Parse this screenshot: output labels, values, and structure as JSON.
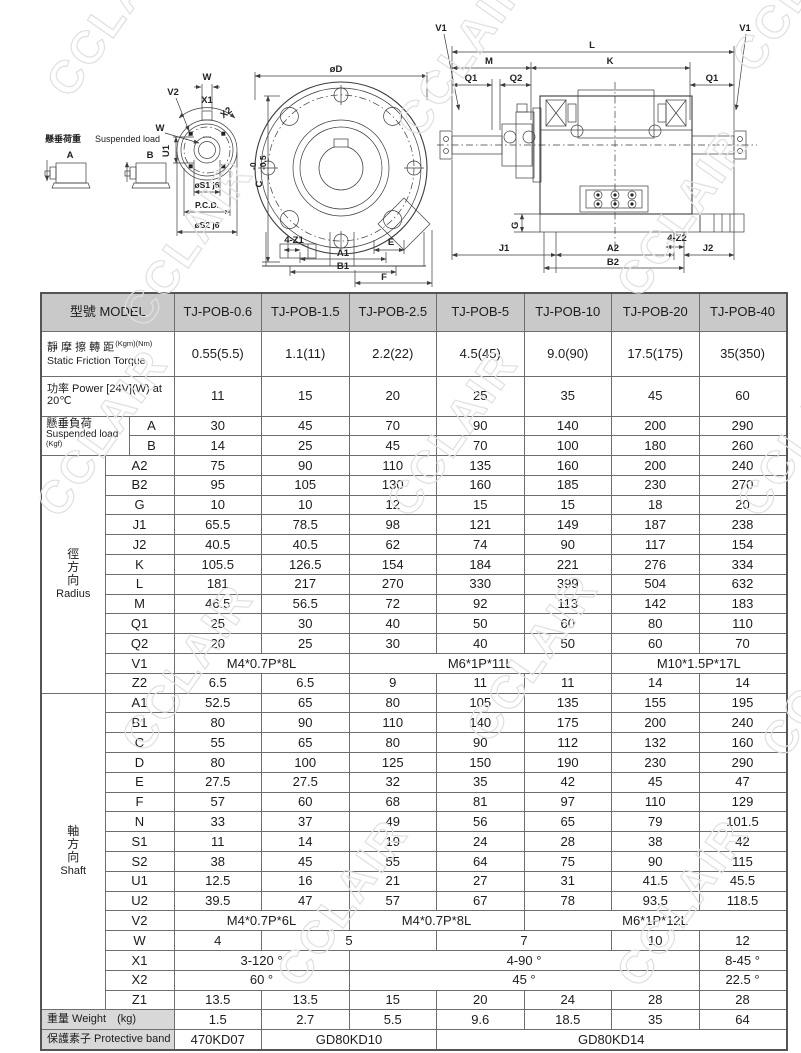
{
  "page": {
    "watermark": "CCLAIR"
  },
  "colors": {
    "header_bg": "#c9c9c9",
    "label_bg": "#d8d8d8",
    "border": "#6e6e6e",
    "line": "#3c3c3c",
    "watermark": "#e0e0e0",
    "text": "#1c1c1c"
  },
  "drawings": {
    "suspended_legend": {
      "zh": "懸垂荷重",
      "en": "Suspended load",
      "a": "A",
      "b": "B"
    },
    "front_small": {
      "v2": "V2",
      "w_top": "W",
      "x1": "X1",
      "x2": "X2",
      "w_left": "W",
      "u1": "U1",
      "s1": "øS1 j6",
      "pcd": "P.C.D.",
      "s2": "øS2 j6"
    },
    "front_large": {
      "d": "øD",
      "c": "C",
      "c_tol_top": "-0",
      "c_tol_bot": "-0.5",
      "z1": "4-Z1",
      "a1": "A1",
      "b1": "B1",
      "e": "E",
      "f": "F"
    },
    "side": {
      "v1l": "V1",
      "v1r": "V1",
      "l": "L",
      "m": "M",
      "k": "K",
      "q1l": "Q1",
      "q2": "Q2",
      "q1r": "Q1",
      "g": "G",
      "j1": "J1",
      "a2": "A2",
      "z2": "4-Z2",
      "j2": "J2",
      "b2": "B2"
    }
  },
  "table": {
    "header": {
      "label": "型號 MODEL",
      "models": [
        "TJ-POB-0.6",
        "TJ-POB-1.5",
        "TJ-POB-2.5",
        "TJ-POB-5",
        "TJ-POB-10",
        "TJ-POB-20",
        "TJ-POB-40"
      ]
    },
    "sections": [
      {
        "l1": "靜 摩 擦 轉 距",
        "unit": "(Kgm)(Nm)",
        "l2": "Static Friction Torque",
        "tall": "torque",
        "cells": [
          "0.55(5.5)",
          "1.1(11)",
          "2.2(22)",
          "4.5(45)",
          "9.0(90)",
          "17.5(175)",
          "35(350)"
        ]
      },
      {
        "l1": "功率 Power [24V](W) at 20℃",
        "tall": "power",
        "cells": [
          "11",
          "15",
          "20",
          "25",
          "35",
          "45",
          "60"
        ]
      },
      {
        "group_l1": "懸垂負荷",
        "group_l2": "Suspended load",
        "group_unit": "(Kgf)",
        "glabel_span": 2,
        "sub_span": 1,
        "rows": [
          {
            "name": "A",
            "cells": [
              "30",
              "45",
              "70",
              "90",
              "140",
              "200",
              "290"
            ]
          },
          {
            "name": "B",
            "cells": [
              "14",
              "25",
              "45",
              "70",
              "100",
              "180",
              "260"
            ]
          }
        ]
      },
      {
        "group_vertical": [
          "徑",
          "方",
          "向"
        ],
        "group_en": "Radius",
        "glabel_span": 1,
        "sub_span": 2,
        "rows": [
          {
            "name": "A2",
            "cells": [
              "75",
              "90",
              "110",
              "135",
              "160",
              "200",
              "240"
            ]
          },
          {
            "name": "B2",
            "cells": [
              "95",
              "105",
              "130",
              "160",
              "185",
              "230",
              "270"
            ]
          },
          {
            "name": "G",
            "cells": [
              "10",
              "10",
              "12",
              "15",
              "15",
              "18",
              "20"
            ]
          },
          {
            "name": "J1",
            "cells": [
              "65.5",
              "78.5",
              "98",
              "121",
              "149",
              "187",
              "238"
            ]
          },
          {
            "name": "J2",
            "cells": [
              "40.5",
              "40.5",
              "62",
              "74",
              "90",
              "117",
              "154"
            ]
          },
          {
            "name": "K",
            "cells": [
              "105.5",
              "126.5",
              "154",
              "184",
              "221",
              "276",
              "334"
            ]
          },
          {
            "name": "L",
            "cells": [
              "181",
              "217",
              "270",
              "330",
              "399",
              "504",
              "632"
            ]
          },
          {
            "name": "M",
            "cells": [
              "46.5",
              "56.5",
              "72",
              "92",
              "113",
              "142",
              "183"
            ]
          },
          {
            "name": "Q1",
            "cells": [
              "25",
              "30",
              "40",
              "50",
              "60",
              "80",
              "110"
            ]
          },
          {
            "name": "Q2",
            "cells": [
              "20",
              "25",
              "30",
              "40",
              "50",
              "60",
              "70"
            ]
          },
          {
            "name": "V1",
            "cells": [
              [
                "M4*0.7P*8L",
                2
              ],
              [
                "M6*1P*11L",
                3
              ],
              [
                "M10*1.5P*17L",
                2
              ]
            ]
          },
          {
            "name": "Z2",
            "cells": [
              "6.5",
              "6.5",
              "9",
              "11",
              "11",
              "14",
              "14"
            ]
          }
        ]
      },
      {
        "group_vertical": [
          "軸",
          "方",
          "向"
        ],
        "group_en": "Shaft",
        "glabel_span": 1,
        "sub_span": 2,
        "rows": [
          {
            "name": "A1",
            "cells": [
              "52.5",
              "65",
              "80",
              "105",
              "135",
              "155",
              "195"
            ]
          },
          {
            "name": "B1",
            "cells": [
              "80",
              "90",
              "110",
              "140",
              "175",
              "200",
              "240"
            ]
          },
          {
            "name": "C",
            "cells": [
              "55",
              "65",
              "80",
              "90",
              "112",
              "132",
              "160"
            ]
          },
          {
            "name": "D",
            "cells": [
              "80",
              "100",
              "125",
              "150",
              "190",
              "230",
              "290"
            ]
          },
          {
            "name": "E",
            "cells": [
              "27.5",
              "27.5",
              "32",
              "35",
              "42",
              "45",
              "47"
            ]
          },
          {
            "name": "F",
            "cells": [
              "57",
              "60",
              "68",
              "81",
              "97",
              "110",
              "129"
            ]
          },
          {
            "name": "N",
            "cells": [
              "33",
              "37",
              "49",
              "56",
              "65",
              "79",
              "101.5"
            ]
          },
          {
            "name": "S1",
            "cells": [
              "11",
              "14",
              "19",
              "24",
              "28",
              "38",
              "42"
            ]
          },
          {
            "name": "S2",
            "cells": [
              "38",
              "45",
              "55",
              "64",
              "75",
              "90",
              "115"
            ]
          },
          {
            "name": "U1",
            "cells": [
              "12.5",
              "16",
              "21",
              "27",
              "31",
              "41.5",
              "45.5"
            ]
          },
          {
            "name": "U2",
            "cells": [
              "39.5",
              "47",
              "57",
              "67",
              "78",
              "93.5",
              "118.5"
            ]
          },
          {
            "name": "V2",
            "cells": [
              [
                "M4*0.7P*6L",
                2
              ],
              [
                "M4*0.7P*8L",
                2
              ],
              [
                "M6*1P*12L",
                3
              ]
            ]
          },
          {
            "name": "W",
            "cells": [
              "4",
              [
                "5",
                2
              ],
              [
                "7",
                2
              ],
              "10",
              "12"
            ]
          },
          {
            "name": "X1",
            "cells": [
              [
                "3-120 °",
                2
              ],
              [
                "4-90 °",
                4
              ],
              [
                "8-45 °",
                1
              ]
            ]
          },
          {
            "name": "X2",
            "cells": [
              [
                "60 °",
                2
              ],
              [
                "45 °",
                4
              ],
              [
                "22.5 °",
                1
              ]
            ]
          },
          {
            "name": "Z1",
            "cells": [
              "13.5",
              "13.5",
              "15",
              "20",
              "24",
              "28",
              "28"
            ]
          }
        ]
      },
      {
        "l1": "重量 Weight　(kg)",
        "gray": true,
        "cells": [
          "1.5",
          "2.7",
          "5.5",
          "9.6",
          "18.5",
          "35",
          "64"
        ]
      },
      {
        "l1": "保護素子 Protective band",
        "gray": true,
        "cells": [
          "470KD07",
          [
            "GD80KD10",
            2
          ],
          [
            "GD80KD14",
            4
          ]
        ]
      }
    ]
  }
}
